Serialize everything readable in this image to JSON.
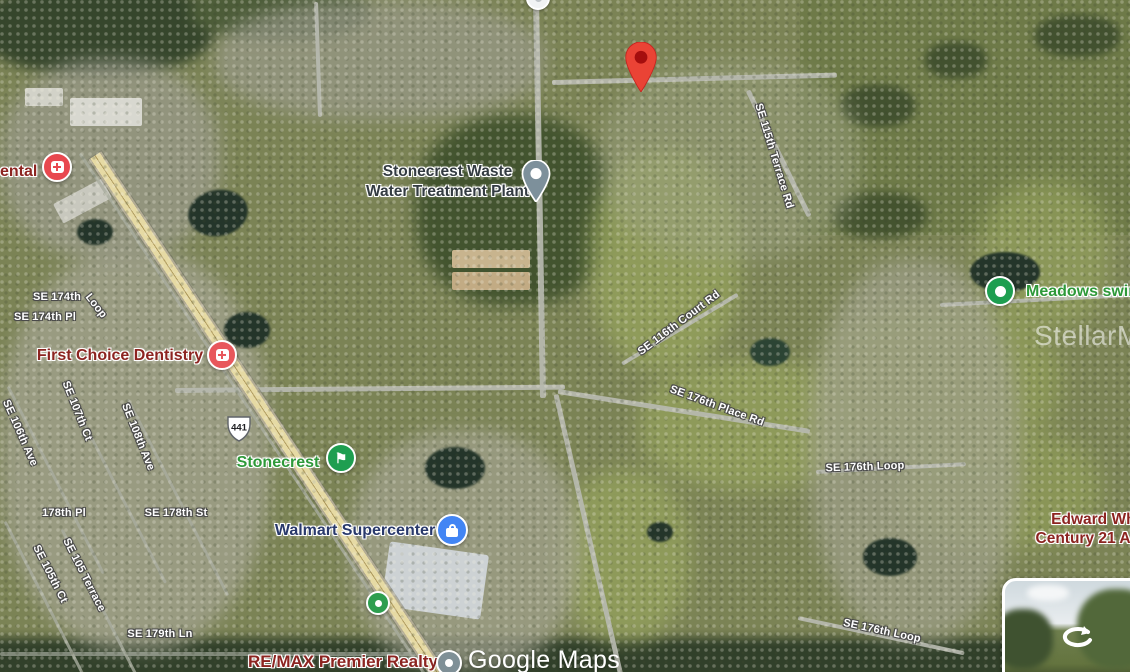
{
  "map": {
    "provider": "Google Maps",
    "watermarks": {
      "mls": "StellarMLS",
      "google": "Google Maps"
    },
    "route_shield": {
      "number": "441"
    },
    "destination_pin": {
      "color": "#EA4335"
    },
    "street_labels": [
      {
        "text": "SE 174th"
      },
      {
        "text": "Loop"
      },
      {
        "text": "SE 174th Pl"
      },
      {
        "text": "SE 106th Ave"
      },
      {
        "text": "SE 107th Ct"
      },
      {
        "text": "SE 108th Ave"
      },
      {
        "text": "178th Pl"
      },
      {
        "text": "SE 178th St"
      },
      {
        "text": "SE 105 Terrace"
      },
      {
        "text": "SE 105th Ct"
      },
      {
        "text": "SE 179th Ln"
      },
      {
        "text": "SE 115th Terrace Rd"
      },
      {
        "text": "SE 116th Court Rd"
      },
      {
        "text": "SE 176th Place Rd"
      },
      {
        "text": "SE 176th Loop"
      },
      {
        "text": "SE 176th Loop"
      }
    ],
    "places": {
      "dental_partial": {
        "name": "ental",
        "category": "health"
      },
      "waste_plant": {
        "name": "Stonecrest Waste Water Treatment Plant",
        "category": "utility"
      },
      "dentistry": {
        "name": "First Choice Dentistry",
        "category": "health"
      },
      "stonecrest_golf": {
        "name": "Stonecrest",
        "category": "golf"
      },
      "meadows": {
        "name": "Meadows swim",
        "category": "recreation"
      },
      "walmart": {
        "name": "Walmart Supercenter",
        "category": "shopping"
      },
      "edward_whitman": {
        "line1": "Edward Whitm",
        "line2": "Century 21 Alton C",
        "category": "real-estate"
      },
      "remax": {
        "name": "RE/MAX Premier Realty",
        "category": "real-estate"
      }
    },
    "icon_colors": {
      "health": "#E8484F",
      "golf": "#1E9E50",
      "recreation": "#1E9E50",
      "shopping": "#4285F4",
      "utility_pin": "#7D909B",
      "generic_gray": "#7F9097",
      "generic_green": "#2E9E4F"
    }
  }
}
